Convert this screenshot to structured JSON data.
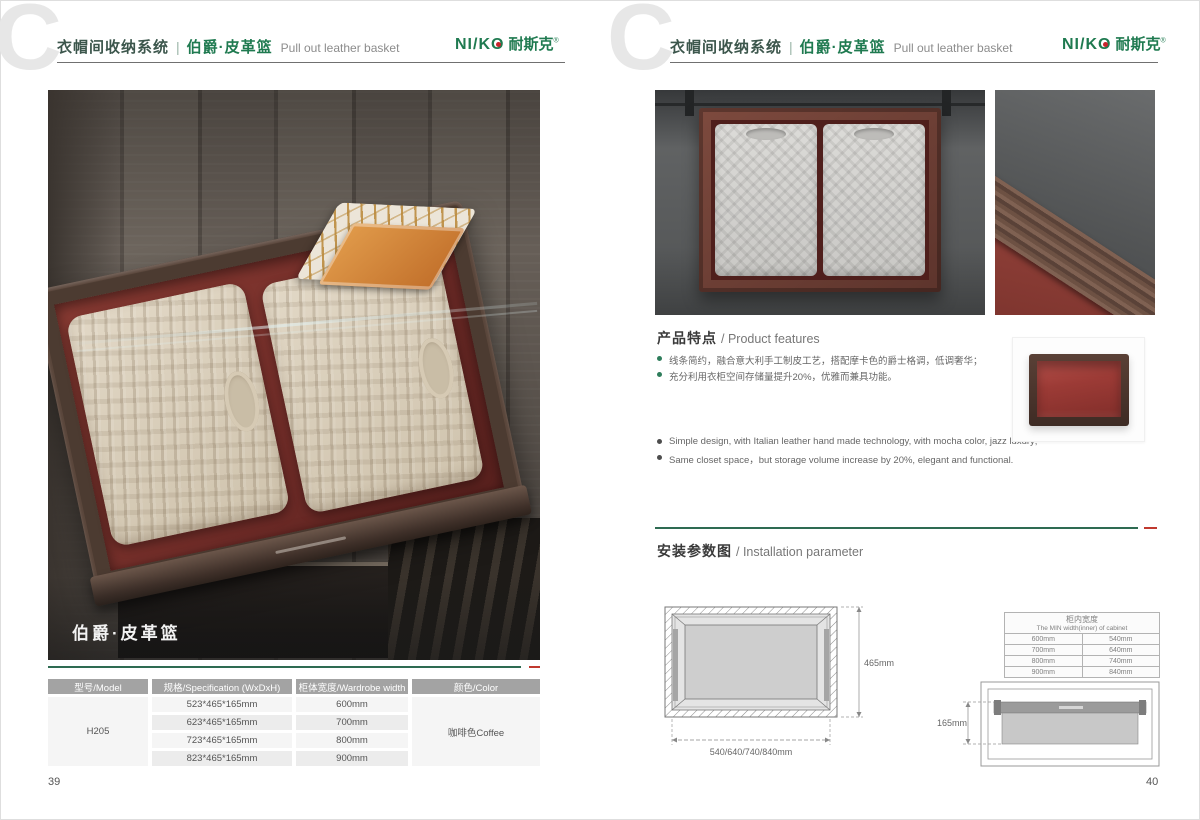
{
  "brand": {
    "logo_prefix": "NI/K",
    "logo_o": "O",
    "logo_cn": "耐斯克",
    "mark": "®"
  },
  "header": {
    "watermark_letter": "C",
    "title_cn": "衣帽间收纳系统",
    "separator": "|",
    "product_cn": "伯爵·皮革篮",
    "product_en": "Pull out leather basket"
  },
  "left_page": {
    "page_number": "39",
    "photo_caption": "伯爵·皮革篮",
    "spec_table": {
      "headers": [
        "型号/Model",
        "规格/Specification (WxDxH)",
        "柜体宽度/Wardrobe width",
        "颜色/Color"
      ],
      "model": "H205",
      "color": "咖啡色Coffee",
      "rows": [
        {
          "spec": "523*465*165mm",
          "width": "600mm"
        },
        {
          "spec": "623*465*165mm",
          "width": "700mm"
        },
        {
          "spec": "723*465*165mm",
          "width": "800mm"
        },
        {
          "spec": "823*465*165mm",
          "width": "900mm"
        }
      ]
    }
  },
  "right_page": {
    "page_number": "40",
    "features": {
      "heading_cn": "产品特点",
      "heading_en": "/ Product features",
      "bullets_cn": [
        "线条简约，融合意大利手工制皮工艺，搭配摩卡色的爵士格调，低调奢华；",
        "充分利用衣柜空间存储量提升20%，优雅而兼具功能。"
      ],
      "bullets_en": [
        "Simple design, with Italian leather hand made technology, with mocha color, jazz luxury;",
        "Same closet space，but storage volume increase by 20%, elegant and functional."
      ]
    },
    "installation": {
      "heading_cn": "安装参数图",
      "heading_en": "/ Installation parameter",
      "top_view": {
        "width_label": "540/640/740/840mm",
        "depth_label": "465mm"
      },
      "min_width_table": {
        "title_cn": "柜内宽度",
        "title_en": "The MIN width(inner) of cabinet",
        "rows": [
          [
            "600mm",
            "540mm"
          ],
          [
            "700mm",
            "640mm"
          ],
          [
            "800mm",
            "740mm"
          ],
          [
            "900mm",
            "840mm"
          ]
        ]
      },
      "front_view": {
        "height_label": "165mm"
      }
    }
  },
  "colors": {
    "brand_green": "#1f7a50",
    "brand_red": "#c8242c",
    "rule_green": "#2e6b52",
    "rule_red": "#c0392f",
    "table_header_bg": "#a3a3a3"
  }
}
